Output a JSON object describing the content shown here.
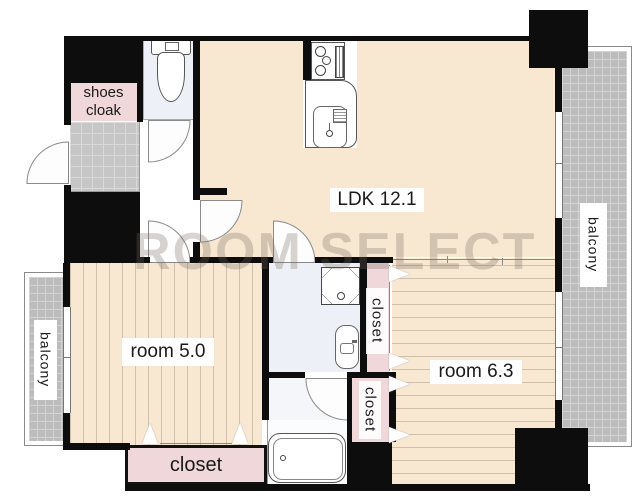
{
  "plan": {
    "watermark": "ROOM SELECT",
    "labels": {
      "ldk": "LDK 12.1",
      "room5": "room 5.0",
      "room6": "room 6.3",
      "shoes_cloak_line1": "shoes",
      "shoes_cloak_line2": "cloak",
      "closet_upper": "closet",
      "closet_lower": "closet",
      "closet_bottom": "closet",
      "balcony_left": "balcony",
      "balcony_right": "balcony"
    },
    "colors": {
      "floor_beige": "#f8e7d1",
      "closet_pink": "#f0d7da",
      "wet_area_blue": "#edf1f7",
      "balcony_gray": "#bcbcbc",
      "wall_black": "#0d0d0d"
    }
  }
}
